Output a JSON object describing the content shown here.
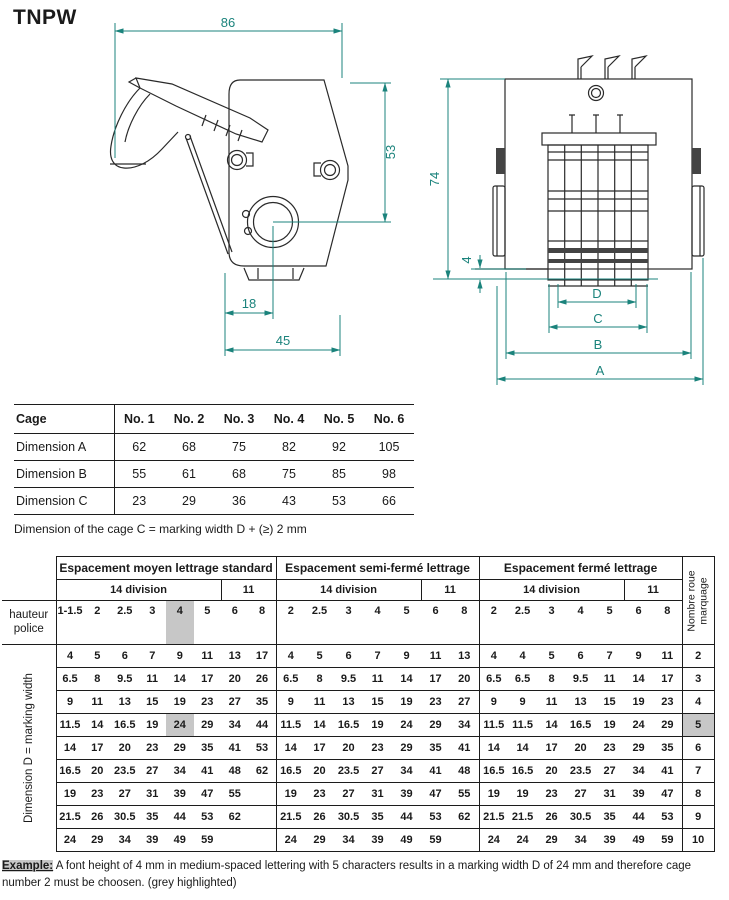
{
  "title": "TNPW",
  "accent_color": "#1b837c",
  "highlight_color": "#c7c7c7",
  "drawing_left": {
    "width_top": "86",
    "height_right": "53",
    "offset_bottom": "18",
    "width_bottom": "45"
  },
  "drawing_right": {
    "height_left": "74",
    "wheel_protrusion": "4",
    "dim_d": "D",
    "dim_c": "C",
    "dim_b": "B",
    "dim_a": "A"
  },
  "cage_table": {
    "header": [
      "Cage",
      "No. 1",
      "No. 2",
      "No. 3",
      "No. 4",
      "No. 5",
      "No. 6"
    ],
    "rows": [
      {
        "label": "Dimension A",
        "values": [
          "62",
          "68",
          "75",
          "82",
          "92",
          "105"
        ]
      },
      {
        "label": "Dimension B",
        "values": [
          "55",
          "61",
          "68",
          "75",
          "85",
          "98"
        ]
      },
      {
        "label": "Dimension C",
        "values": [
          "23",
          "29",
          "36",
          "43",
          "53",
          "66"
        ]
      }
    ],
    "note": "Dimension of the cage C = marking width D + (≥) 2 mm"
  },
  "matrix_table": {
    "left_header_label": "hauteur police",
    "left_data_label": "Dimension D = marking width",
    "right_label": "Nombre roue marquage",
    "sections": [
      {
        "title": "Espacement moyen lettrage standard",
        "group14": "14 division",
        "group11": "11",
        "header_values": [
          "1-1.5",
          "2",
          "2.5",
          "3",
          "4",
          "5",
          "6",
          "8"
        ]
      },
      {
        "title": "Espacement semi-fermé lettrage",
        "group14": "14 division",
        "group11": "11",
        "header_values": [
          "2",
          "2.5",
          "3",
          "4",
          "5",
          "6",
          "8"
        ]
      },
      {
        "title": "Espacement fermé lettrage",
        "group14": "14 division",
        "group11": "11",
        "header_values": [
          "2",
          "2.5",
          "3",
          "4",
          "5",
          "6",
          "8"
        ]
      }
    ],
    "highlight": {
      "section": 0,
      "col": 4,
      "row": 3
    },
    "rows": [
      {
        "cells": [
          [
            "4",
            "5",
            "6",
            "7",
            "9",
            "11",
            "13",
            "17"
          ],
          [
            "4",
            "5",
            "6",
            "7",
            "9",
            "11",
            "13"
          ],
          [
            "4",
            "4",
            "5",
            "6",
            "7",
            "9",
            "11"
          ]
        ],
        "wheels": "2"
      },
      {
        "cells": [
          [
            "6.5",
            "8",
            "9.5",
            "11",
            "14",
            "17",
            "20",
            "26"
          ],
          [
            "6.5",
            "8",
            "9.5",
            "11",
            "14",
            "17",
            "20"
          ],
          [
            "6.5",
            "6.5",
            "8",
            "9.5",
            "11",
            "14",
            "17"
          ]
        ],
        "wheels": "3"
      },
      {
        "cells": [
          [
            "9",
            "11",
            "13",
            "15",
            "19",
            "23",
            "27",
            "35"
          ],
          [
            "9",
            "11",
            "13",
            "15",
            "19",
            "23",
            "27"
          ],
          [
            "9",
            "9",
            "11",
            "13",
            "15",
            "19",
            "23"
          ]
        ],
        "wheels": "4"
      },
      {
        "cells": [
          [
            "11.5",
            "14",
            "16.5",
            "19",
            "24",
            "29",
            "34",
            "44"
          ],
          [
            "11.5",
            "14",
            "16.5",
            "19",
            "24",
            "29",
            "34"
          ],
          [
            "11.5",
            "11.5",
            "14",
            "16.5",
            "19",
            "24",
            "29"
          ]
        ],
        "wheels": "5"
      },
      {
        "cells": [
          [
            "14",
            "17",
            "20",
            "23",
            "29",
            "35",
            "41",
            "53"
          ],
          [
            "14",
            "17",
            "20",
            "23",
            "29",
            "35",
            "41"
          ],
          [
            "14",
            "14",
            "17",
            "20",
            "23",
            "29",
            "35"
          ]
        ],
        "wheels": "6"
      },
      {
        "cells": [
          [
            "16.5",
            "20",
            "23.5",
            "27",
            "34",
            "41",
            "48",
            "62"
          ],
          [
            "16.5",
            "20",
            "23.5",
            "27",
            "34",
            "41",
            "48"
          ],
          [
            "16.5",
            "16.5",
            "20",
            "23.5",
            "27",
            "34",
            "41"
          ]
        ],
        "wheels": "7"
      },
      {
        "cells": [
          [
            "19",
            "23",
            "27",
            "31",
            "39",
            "47",
            "55",
            ""
          ],
          [
            "19",
            "23",
            "27",
            "31",
            "39",
            "47",
            "55"
          ],
          [
            "19",
            "19",
            "23",
            "27",
            "31",
            "39",
            "47"
          ]
        ],
        "wheels": "8"
      },
      {
        "cells": [
          [
            "21.5",
            "26",
            "30.5",
            "35",
            "44",
            "53",
            "62",
            ""
          ],
          [
            "21.5",
            "26",
            "30.5",
            "35",
            "44",
            "53",
            "62"
          ],
          [
            "21.5",
            "21.5",
            "26",
            "30.5",
            "35",
            "44",
            "53"
          ]
        ],
        "wheels": "9"
      },
      {
        "cells": [
          [
            "24",
            "29",
            "34",
            "39",
            "49",
            "59",
            "",
            ""
          ],
          [
            "24",
            "29",
            "34",
            "39",
            "49",
            "59",
            ""
          ],
          [
            "24",
            "24",
            "29",
            "34",
            "39",
            "49",
            "59"
          ]
        ],
        "wheels": "10"
      }
    ]
  },
  "example": {
    "label": "Example:",
    "text": "A font height of 4 mm in medium-spaced lettering with 5 characters results in a marking width D of 24 mm and therefore cage number 2 must be choosen. (grey highlighted)"
  }
}
